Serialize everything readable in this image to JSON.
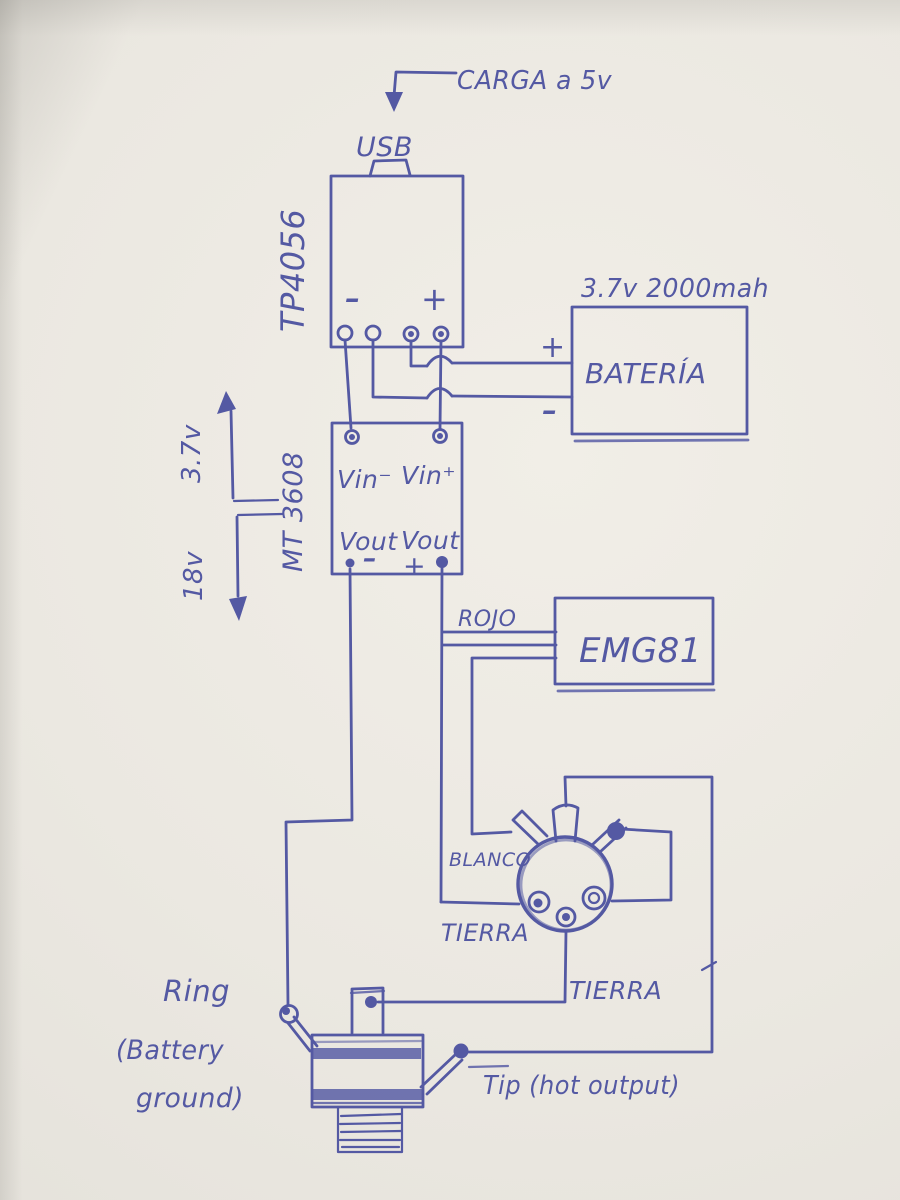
{
  "colors": {
    "ink": "#5459a3",
    "paper": "#ebe8e1",
    "paper_shadow": "#dbd8d1"
  },
  "diagram": {
    "charge_label": "CARGA a 5v",
    "usb_label": "USB",
    "charger_module": "TP4056",
    "charger_minus": "-",
    "charger_plus": "+",
    "battery_specs": "3.7v 2000mah",
    "battery_label": "BATERÍA",
    "battery_plus": "+",
    "battery_minus": "-",
    "boost_module": "MT 3608",
    "vin_minus": "Vin⁻",
    "vin_plus": "Vin⁺",
    "vout_left": "Vout",
    "vout_minus_sign": "-",
    "vout_right": "Vout",
    "vout_plus_sign": "+",
    "input_voltage": "3.7v",
    "output_voltage": "18v",
    "wire_red": "ROJO",
    "pickup_label": "EMG81",
    "wire_white": "BLANCO",
    "ground_connector": "TIERRA",
    "ground_jack": "TIERRA",
    "ring_l1": "Ring",
    "ring_l2": "(Battery",
    "ring_l3": "ground)",
    "tip_label": "Tip (hot output)"
  }
}
